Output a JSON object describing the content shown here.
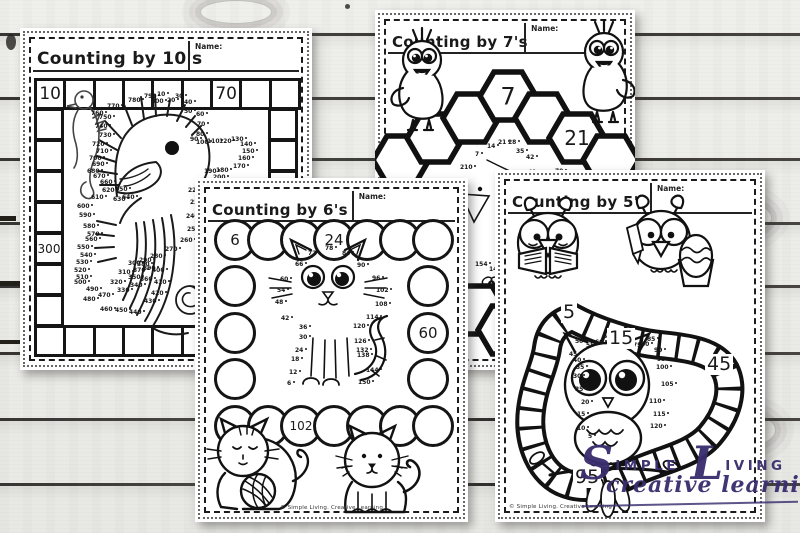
{
  "watermark": {
    "big1": "S",
    "rest1": "IMPLE",
    "big2": "L",
    "rest2": "IVING",
    "line2": "creative learning",
    "color": "#3a2e6e"
  },
  "pages": {
    "tens": {
      "title": "Counting by 10's",
      "name_label": "Name:",
      "track_labels": [
        {
          "side": "top",
          "index": 0,
          "text": "10"
        },
        {
          "side": "top",
          "index": 6,
          "text": "70"
        },
        {
          "side": "left",
          "index": 4,
          "text": "300"
        }
      ],
      "dots": [
        {
          "n": "10",
          "x": 137,
          "y": 64
        },
        {
          "n": "20",
          "x": 147,
          "y": 70
        },
        {
          "n": "30",
          "x": 155,
          "y": 66
        },
        {
          "n": "40",
          "x": 164,
          "y": 72
        },
        {
          "n": "50",
          "x": 164,
          "y": 81
        },
        {
          "n": "60",
          "x": 176,
          "y": 84
        },
        {
          "n": "70",
          "x": 177,
          "y": 94
        },
        {
          "n": "80",
          "x": 176,
          "y": 104
        },
        {
          "n": "90",
          "x": 170,
          "y": 109
        },
        {
          "n": "100",
          "x": 176,
          "y": 112
        },
        {
          "n": "110",
          "x": 187,
          "y": 111
        },
        {
          "n": "120",
          "x": 199,
          "y": 111
        },
        {
          "n": "130",
          "x": 211,
          "y": 109
        },
        {
          "n": "140",
          "x": 220,
          "y": 114
        },
        {
          "n": "150",
          "x": 222,
          "y": 121
        },
        {
          "n": "160",
          "x": 218,
          "y": 128
        },
        {
          "n": "170",
          "x": 213,
          "y": 136
        },
        {
          "n": "180",
          "x": 196,
          "y": 140
        },
        {
          "n": "190",
          "x": 184,
          "y": 141
        },
        {
          "n": "200",
          "x": 193,
          "y": 147
        },
        {
          "n": "210",
          "x": 178,
          "y": 153
        },
        {
          "n": "220",
          "x": 168,
          "y": 160
        },
        {
          "n": "230",
          "x": 170,
          "y": 172
        },
        {
          "n": "240",
          "x": 166,
          "y": 186
        },
        {
          "n": "250",
          "x": 167,
          "y": 199
        },
        {
          "n": "260",
          "x": 160,
          "y": 210
        },
        {
          "n": "270",
          "x": 145,
          "y": 219
        },
        {
          "n": "280",
          "x": 130,
          "y": 226
        },
        {
          "n": "290",
          "x": 119,
          "y": 230
        },
        {
          "n": "300",
          "x": 108,
          "y": 233
        },
        {
          "n": "310",
          "x": 98,
          "y": 242
        },
        {
          "n": "320",
          "x": 90,
          "y": 252
        },
        {
          "n": "330",
          "x": 97,
          "y": 260
        },
        {
          "n": "340",
          "x": 110,
          "y": 255
        },
        {
          "n": "350",
          "x": 108,
          "y": 247
        },
        {
          "n": "360",
          "x": 120,
          "y": 249
        },
        {
          "n": "370",
          "x": 113,
          "y": 240
        },
        {
          "n": "380",
          "x": 117,
          "y": 234
        },
        {
          "n": "390",
          "x": 123,
          "y": 238
        },
        {
          "n": "400",
          "x": 132,
          "y": 240
        },
        {
          "n": "410",
          "x": 134,
          "y": 252
        },
        {
          "n": "420",
          "x": 131,
          "y": 263
        },
        {
          "n": "430",
          "x": 124,
          "y": 271
        },
        {
          "n": "440",
          "x": 109,
          "y": 282
        },
        {
          "n": "450",
          "x": 95,
          "y": 280
        },
        {
          "n": "460",
          "x": 80,
          "y": 279
        },
        {
          "n": "470",
          "x": 78,
          "y": 265
        },
        {
          "n": "480",
          "x": 63,
          "y": 269
        },
        {
          "n": "490",
          "x": 66,
          "y": 259
        },
        {
          "n": "500",
          "x": 54,
          "y": 252
        },
        {
          "n": "510",
          "x": 56,
          "y": 247
        },
        {
          "n": "520",
          "x": 54,
          "y": 240
        },
        {
          "n": "530",
          "x": 56,
          "y": 232
        },
        {
          "n": "540",
          "x": 60,
          "y": 225
        },
        {
          "n": "550",
          "x": 57,
          "y": 217
        },
        {
          "n": "560",
          "x": 65,
          "y": 209
        },
        {
          "n": "570",
          "x": 67,
          "y": 204
        },
        {
          "n": "580",
          "x": 63,
          "y": 196
        },
        {
          "n": "590",
          "x": 59,
          "y": 185
        },
        {
          "n": "600",
          "x": 57,
          "y": 176
        },
        {
          "n": "610",
          "x": 71,
          "y": 167
        },
        {
          "n": "620",
          "x": 82,
          "y": 160
        },
        {
          "n": "630",
          "x": 93,
          "y": 169
        },
        {
          "n": "640",
          "x": 102,
          "y": 167
        },
        {
          "n": "650",
          "x": 95,
          "y": 159
        },
        {
          "n": "660",
          "x": 80,
          "y": 152
        },
        {
          "n": "670",
          "x": 73,
          "y": 146
        },
        {
          "n": "680",
          "x": 67,
          "y": 141
        },
        {
          "n": "690",
          "x": 72,
          "y": 134
        },
        {
          "n": "700",
          "x": 69,
          "y": 128
        },
        {
          "n": "710",
          "x": 76,
          "y": 121
        },
        {
          "n": "720",
          "x": 72,
          "y": 114
        },
        {
          "n": "730",
          "x": 79,
          "y": 105
        },
        {
          "n": "740",
          "x": 75,
          "y": 96
        },
        {
          "n": "750",
          "x": 79,
          "y": 87
        },
        {
          "n": "760",
          "x": 71,
          "y": 83
        },
        {
          "n": "770",
          "x": 87,
          "y": 76
        },
        {
          "n": "780",
          "x": 108,
          "y": 70
        },
        {
          "n": "790",
          "x": 124,
          "y": 66
        },
        {
          "n": "800",
          "x": 131,
          "y": 71
        }
      ]
    },
    "sevens": {
      "title": "Counting by 7's",
      "name_label": "Name:",
      "hex_labels": [
        {
          "index": 3,
          "text": "7"
        },
        {
          "index": 5,
          "text": "21"
        }
      ],
      "bottom_hex_label": "70",
      "dots": [
        {
          "n": "210",
          "x": 85,
          "y": 155
        },
        {
          "n": "7",
          "x": 100,
          "y": 142
        },
        {
          "n": "14",
          "x": 112,
          "y": 134
        },
        {
          "n": "21",
          "x": 123,
          "y": 130
        },
        {
          "n": "28",
          "x": 133,
          "y": 130
        },
        {
          "n": "35",
          "x": 141,
          "y": 139
        },
        {
          "n": "42",
          "x": 151,
          "y": 145
        },
        {
          "n": "49",
          "x": 153,
          "y": 160
        },
        {
          "n": "63",
          "x": 168,
          "y": 163
        },
        {
          "n": "70",
          "x": 180,
          "y": 159
        },
        {
          "n": "154",
          "x": 100,
          "y": 252
        },
        {
          "n": "147",
          "x": 114,
          "y": 257
        }
      ]
    },
    "sixes": {
      "title": "Counting by 6's",
      "name_label": "Name:",
      "circle_labels": [
        {
          "pos": "top-0",
          "text": "6"
        },
        {
          "pos": "top-3",
          "text": "24"
        },
        {
          "pos": "right-1",
          "text": "60"
        },
        {
          "pos": "bottom-2",
          "text": "102"
        }
      ],
      "copyright": "© Simple Living. Creative Learning",
      "dots": [
        {
          "n": "72",
          "x": 113,
          "y": 73
        },
        {
          "n": "78",
          "x": 130,
          "y": 68
        },
        {
          "n": "84",
          "x": 147,
          "y": 73
        },
        {
          "n": "66",
          "x": 100,
          "y": 84
        },
        {
          "n": "90",
          "x": 162,
          "y": 85
        },
        {
          "n": "60",
          "x": 85,
          "y": 99
        },
        {
          "n": "96",
          "x": 177,
          "y": 98
        },
        {
          "n": "54",
          "x": 82,
          "y": 110
        },
        {
          "n": "102",
          "x": 181,
          "y": 110
        },
        {
          "n": "48",
          "x": 80,
          "y": 122
        },
        {
          "n": "108",
          "x": 180,
          "y": 124
        },
        {
          "n": "42",
          "x": 86,
          "y": 138
        },
        {
          "n": "114",
          "x": 171,
          "y": 137
        },
        {
          "n": "36",
          "x": 104,
          "y": 147
        },
        {
          "n": "120",
          "x": 158,
          "y": 146
        },
        {
          "n": "30",
          "x": 104,
          "y": 157
        },
        {
          "n": "126",
          "x": 159,
          "y": 161
        },
        {
          "n": "24",
          "x": 100,
          "y": 170
        },
        {
          "n": "132",
          "x": 161,
          "y": 170
        },
        {
          "n": "18",
          "x": 96,
          "y": 179
        },
        {
          "n": "138",
          "x": 162,
          "y": 175
        },
        {
          "n": "12",
          "x": 94,
          "y": 192
        },
        {
          "n": "144",
          "x": 171,
          "y": 190
        },
        {
          "n": "6",
          "x": 92,
          "y": 203
        },
        {
          "n": "150",
          "x": 163,
          "y": 202
        }
      ]
    },
    "fives": {
      "title": "Counting by 5's",
      "name_label": "Name:",
      "path_labels": [
        {
          "text": "5",
          "x": 66,
          "y": 132
        },
        {
          "text": "15",
          "x": 112,
          "y": 158
        },
        {
          "text": "45",
          "x": 210,
          "y": 184
        },
        {
          "text": "95",
          "x": 78,
          "y": 297
        }
      ],
      "copyright": "© Simple Living. Creative Learning",
      "dots": [
        {
          "n": "50",
          "x": 80,
          "y": 169
        },
        {
          "n": "55",
          "x": 91,
          "y": 173
        },
        {
          "n": "60",
          "x": 100,
          "y": 170
        },
        {
          "n": "65",
          "x": 108,
          "y": 164
        },
        {
          "n": "70",
          "x": 127,
          "y": 166
        },
        {
          "n": "75",
          "x": 138,
          "y": 173
        },
        {
          "n": "80",
          "x": 146,
          "y": 172
        },
        {
          "n": "85",
          "x": 152,
          "y": 167
        },
        {
          "n": "90",
          "x": 159,
          "y": 178
        },
        {
          "n": "95",
          "x": 162,
          "y": 187
        },
        {
          "n": "100",
          "x": 161,
          "y": 195
        },
        {
          "n": "105",
          "x": 166,
          "y": 212
        },
        {
          "n": "110",
          "x": 154,
          "y": 229
        },
        {
          "n": "115",
          "x": 158,
          "y": 242
        },
        {
          "n": "120",
          "x": 155,
          "y": 254
        },
        {
          "n": "45",
          "x": 74,
          "y": 182
        },
        {
          "n": "40",
          "x": 78,
          "y": 188
        },
        {
          "n": "35",
          "x": 81,
          "y": 195
        },
        {
          "n": "30",
          "x": 78,
          "y": 204
        },
        {
          "n": "25",
          "x": 80,
          "y": 217
        },
        {
          "n": "20",
          "x": 86,
          "y": 230
        },
        {
          "n": "15",
          "x": 82,
          "y": 242
        },
        {
          "n": "10",
          "x": 82,
          "y": 256
        },
        {
          "n": "5",
          "x": 93,
          "y": 264
        }
      ]
    }
  }
}
